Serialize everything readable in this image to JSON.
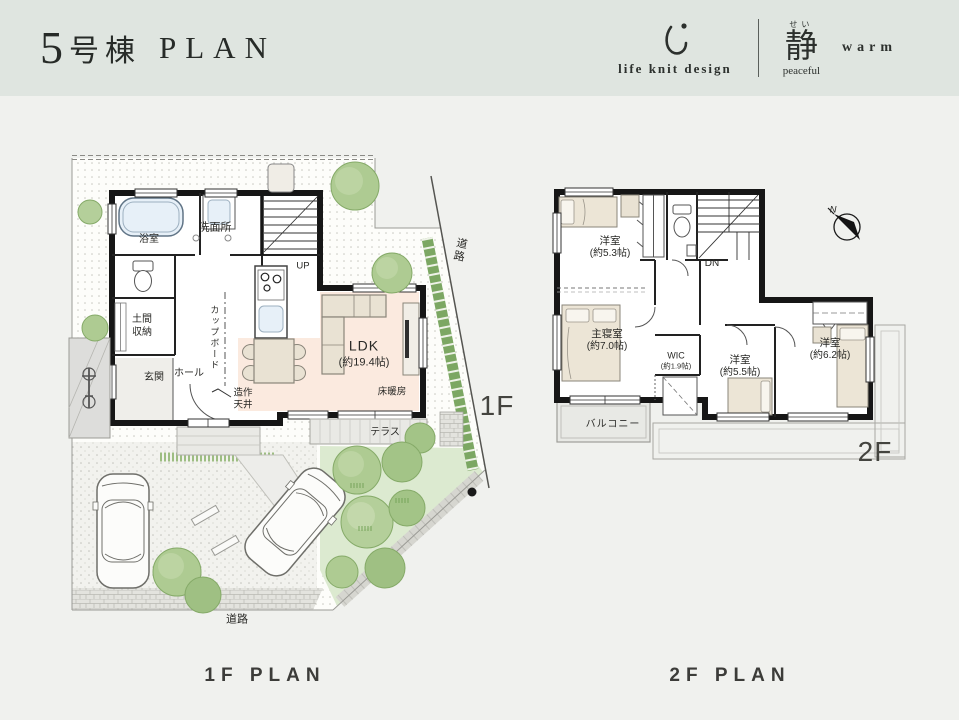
{
  "header": {
    "title_number": "5",
    "title_suffix": "号棟",
    "title_plan": "PLAN",
    "brand": {
      "name": "life knit design",
      "concept_furigana": "せい",
      "concept_kanji": "静",
      "concept_reading": "peaceful",
      "keyword": "warm"
    }
  },
  "floor1": {
    "badge": "1F",
    "caption": "1F PLAN",
    "labels": {
      "bath": "浴室",
      "washroom": "洗面所",
      "stairs": "UP",
      "doma_storage": "土間収納",
      "entrance": "玄関",
      "hall": "ホール",
      "cupboard": "カップボード",
      "ldk": "LDK",
      "ldk_size": "(約19.4帖)",
      "floor_heating": "床暖房",
      "custom_ceiling": "造作天井",
      "terrace": "テラス",
      "road_side": "道路",
      "road_front": "道路"
    }
  },
  "floor2": {
    "badge": "2F",
    "caption": "2F PLAN",
    "compass_north": "N",
    "labels": {
      "bedroom_a": "洋室",
      "bedroom_a_size": "(約5.3帖)",
      "stairs": "DN",
      "master_bedroom": "主寝室",
      "master_bedroom_size": "(約7.0帖)",
      "wic": "WIC",
      "wic_size": "(約1.9帖)",
      "bedroom_b": "洋室",
      "bedroom_b_size": "(約5.5帖)",
      "bedroom_c": "洋室",
      "bedroom_c_size": "(約6.2帖)",
      "balcony": "バルコニー"
    }
  }
}
